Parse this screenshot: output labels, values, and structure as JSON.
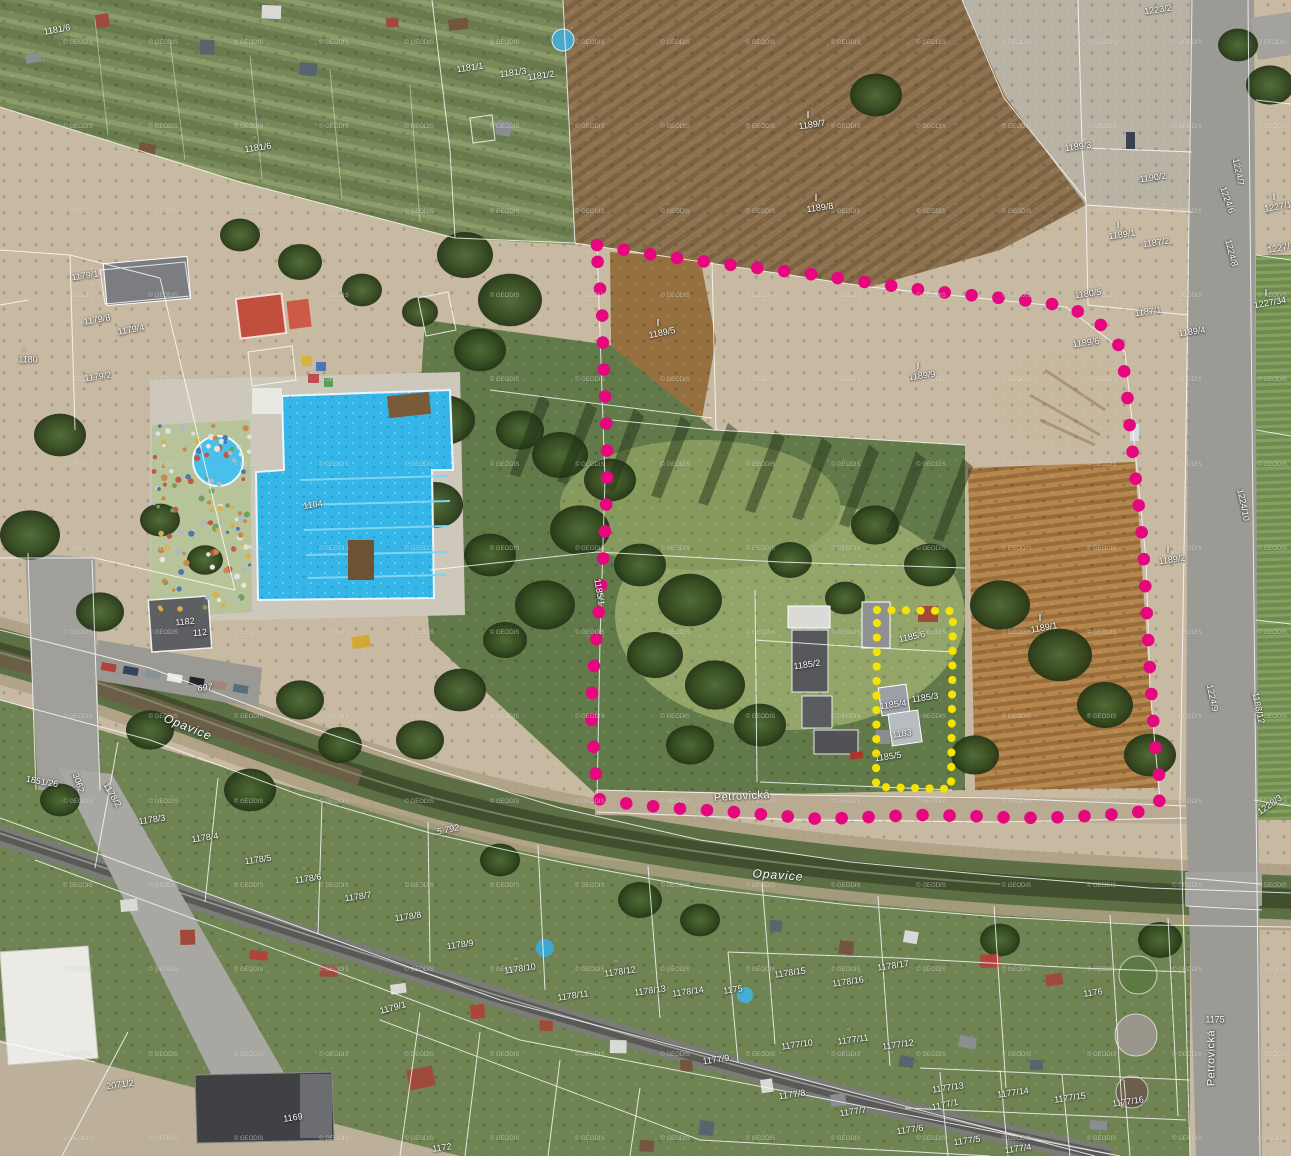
{
  "map": {
    "copyright": "© GEODIS",
    "watermark_grid": {
      "start_x": 78,
      "start_y": 43,
      "step_x": 85.3,
      "step_y": 84.3,
      "cols": 15,
      "rows": 14
    },
    "boundaries": {
      "selection_primary": {
        "name": "selection-boundary-magenta",
        "color": "#e6077e",
        "dot_radius": 6.3,
        "dot_spacing": 27,
        "vertices": [
          [
            597,
            245
          ],
          [
            660,
            256
          ],
          [
            740,
            266
          ],
          [
            810,
            274
          ],
          [
            872,
            283
          ],
          [
            930,
            291
          ],
          [
            980,
            296
          ],
          [
            1022,
            300
          ],
          [
            1066,
            306
          ],
          [
            1096,
            320
          ],
          [
            1118,
            343
          ],
          [
            1126,
            380
          ],
          [
            1130,
            430
          ],
          [
            1137,
            490
          ],
          [
            1143,
            545
          ],
          [
            1146,
            600
          ],
          [
            1149,
            655
          ],
          [
            1152,
            705
          ],
          [
            1156,
            755
          ],
          [
            1162,
            795
          ],
          [
            1155,
            810
          ],
          [
            1120,
            814
          ],
          [
            1070,
            817
          ],
          [
            1020,
            818
          ],
          [
            970,
            816
          ],
          [
            920,
            815
          ],
          [
            870,
            817
          ],
          [
            820,
            819
          ],
          [
            770,
            815
          ],
          [
            720,
            811
          ],
          [
            670,
            808
          ],
          [
            630,
            804
          ],
          [
            598,
            799
          ],
          [
            594,
            755
          ],
          [
            591,
            710
          ],
          [
            594,
            665
          ],
          [
            598,
            620
          ],
          [
            602,
            575
          ],
          [
            605,
            530
          ],
          [
            607,
            485
          ],
          [
            607,
            440
          ],
          [
            605,
            395
          ],
          [
            603,
            350
          ],
          [
            602,
            305
          ],
          [
            598,
            272
          ]
        ]
      },
      "selection_secondary": {
        "name": "selection-boundary-yellow",
        "color": "#f5e400",
        "dot_radius": 4.1,
        "dot_spacing": 14.5,
        "vertices": [
          [
            877,
            610
          ],
          [
            953,
            611
          ],
          [
            951,
            789
          ],
          [
            876,
            787
          ]
        ]
      }
    },
    "rivers": [
      {
        "name": "Opavice",
        "x": 188,
        "y": 727,
        "rot": 22
      },
      {
        "name": "Opavice",
        "x": 778,
        "y": 875,
        "rot": 4
      }
    ],
    "streets": [
      {
        "name": "Petrovická",
        "x": 742,
        "y": 797,
        "rot": -3
      },
      {
        "name": "Petrovická",
        "x": 1212,
        "y": 1058,
        "rot": -90
      }
    ],
    "parcel_labels": [
      {
        "t": "1181/6",
        "x": 57,
        "y": 30,
        "r": -10
      },
      {
        "t": "1181/1",
        "x": 470,
        "y": 68,
        "r": -8
      },
      {
        "t": "1181/3",
        "x": 513,
        "y": 73,
        "r": -8
      },
      {
        "t": "1181/2",
        "x": 541,
        "y": 76,
        "r": -8
      },
      {
        "t": "1223/2",
        "x": 1158,
        "y": 10,
        "r": -8
      },
      {
        "t": "1189/7",
        "x": 812,
        "y": 125,
        "r": -8,
        "sym": "slope"
      },
      {
        "t": "1181/6",
        "x": 258,
        "y": 148,
        "r": -8,
        "sym": "circle"
      },
      {
        "t": "1189/3",
        "x": 1078,
        "y": 147,
        "r": -8
      },
      {
        "t": "1190/2",
        "x": 1153,
        "y": 178,
        "r": -8
      },
      {
        "t": "1224/7",
        "x": 1238,
        "y": 172,
        "r": 78
      },
      {
        "t": "1224/6",
        "x": 1227,
        "y": 200,
        "r": 70
      },
      {
        "t": "1227/1",
        "x": 1278,
        "y": 207,
        "r": -10,
        "sym": "slope"
      },
      {
        "t": "1189/8",
        "x": 820,
        "y": 208,
        "r": -8,
        "sym": "slope"
      },
      {
        "t": "1189/1",
        "x": 1122,
        "y": 235,
        "r": -8,
        "sym": "slope"
      },
      {
        "t": "1187/2",
        "x": 1156,
        "y": 243,
        "r": -8
      },
      {
        "t": "1227/7",
        "x": 1281,
        "y": 248,
        "r": -10
      },
      {
        "t": "1224/8",
        "x": 1231,
        "y": 253,
        "r": 75
      },
      {
        "t": "1179/1",
        "x": 85,
        "y": 276,
        "r": -8
      },
      {
        "t": "1180/5",
        "x": 1088,
        "y": 294,
        "r": -8
      },
      {
        "t": "1227/34",
        "x": 1270,
        "y": 303,
        "r": -10,
        "sym": "slope"
      },
      {
        "t": "1187/1",
        "x": 1148,
        "y": 312,
        "r": -8
      },
      {
        "t": "1179/8",
        "x": 97,
        "y": 320,
        "r": -10
      },
      {
        "t": "1179/4",
        "x": 131,
        "y": 330,
        "r": -10
      },
      {
        "t": "1189/5",
        "x": 662,
        "y": 333,
        "r": -12,
        "sym": "slope"
      },
      {
        "t": "1189/6",
        "x": 1086,
        "y": 343,
        "r": -8
      },
      {
        "t": "1189/4",
        "x": 1192,
        "y": 332,
        "r": -8
      },
      {
        "t": "1180",
        "x": 28,
        "y": 360,
        "r": 0,
        "sym": "circle"
      },
      {
        "t": "1189/9",
        "x": 922,
        "y": 376,
        "r": -8,
        "sym": "slope"
      },
      {
        "t": "1179/2",
        "x": 98,
        "y": 377,
        "r": -8
      },
      {
        "t": "1184",
        "x": 313,
        "y": 505,
        "r": -8
      },
      {
        "t": "1224/10",
        "x": 1243,
        "y": 505,
        "r": 78
      },
      {
        "t": "1189/2",
        "x": 1172,
        "y": 560,
        "r": -8,
        "sym": "slope"
      },
      {
        "t": "1185/1",
        "x": 599,
        "y": 592,
        "r": 80
      },
      {
        "t": "1182",
        "x": 185,
        "y": 622,
        "r": -5
      },
      {
        "t": "112",
        "x": 200,
        "y": 633,
        "r": -5
      },
      {
        "t": "1185/6",
        "x": 912,
        "y": 637,
        "r": -12
      },
      {
        "t": "1189/1",
        "x": 1044,
        "y": 628,
        "r": -10,
        "sym": "slope"
      },
      {
        "t": "1185/2",
        "x": 807,
        "y": 665,
        "r": -8
      },
      {
        "t": "1224/9",
        "x": 1212,
        "y": 698,
        "r": 78
      },
      {
        "t": "1185/3",
        "x": 925,
        "y": 698,
        "r": -8
      },
      {
        "t": "1185/4",
        "x": 893,
        "y": 705,
        "r": -8
      },
      {
        "t": "1188/12",
        "x": 1258,
        "y": 708,
        "r": 78
      },
      {
        "t": "1183",
        "x": 902,
        "y": 734,
        "r": -8
      },
      {
        "t": "1185/5",
        "x": 888,
        "y": 757,
        "r": -8
      },
      {
        "t": "3062",
        "x": 78,
        "y": 783,
        "r": 72
      },
      {
        "t": "1851/26",
        "x": 42,
        "y": 782,
        "r": 10
      },
      {
        "t": "1178/2",
        "x": 112,
        "y": 795,
        "r": 60
      },
      {
        "t": "1228/3",
        "x": 1270,
        "y": 805,
        "r": -35
      },
      {
        "t": "1178/3",
        "x": 152,
        "y": 820,
        "r": -8
      },
      {
        "t": "1178/4",
        "x": 205,
        "y": 838,
        "r": -8
      },
      {
        "t": "1178/5",
        "x": 258,
        "y": 860,
        "r": -8
      },
      {
        "t": "1178/6",
        "x": 308,
        "y": 879,
        "r": -8,
        "sym": "circle"
      },
      {
        "t": "1178/7",
        "x": 358,
        "y": 897,
        "r": -8
      },
      {
        "t": "1178/8",
        "x": 408,
        "y": 917,
        "r": -8
      },
      {
        "t": "1178/9",
        "x": 460,
        "y": 945,
        "r": -8
      },
      {
        "t": "1178/10",
        "x": 520,
        "y": 969,
        "r": -8,
        "sym": "circle"
      },
      {
        "t": "1178/12",
        "x": 620,
        "y": 972,
        "r": -8,
        "sym": "circle"
      },
      {
        "t": "1178/17",
        "x": 893,
        "y": 966,
        "r": -8
      },
      {
        "t": "1178/15",
        "x": 790,
        "y": 973,
        "r": -8
      },
      {
        "t": "1178/16",
        "x": 848,
        "y": 982,
        "r": -8
      },
      {
        "t": "1175",
        "x": 733,
        "y": 990,
        "r": -8
      },
      {
        "t": "1176",
        "x": 1093,
        "y": 993,
        "r": -8
      },
      {
        "t": "1178/13",
        "x": 650,
        "y": 991,
        "r": -8
      },
      {
        "t": "1178/14",
        "x": 688,
        "y": 992,
        "r": -8
      },
      {
        "t": "1178/11",
        "x": 573,
        "y": 996,
        "r": -8
      },
      {
        "t": "1179/1",
        "x": 393,
        "y": 1008,
        "r": -15,
        "sym": "circle"
      },
      {
        "t": "1175",
        "x": 1215,
        "y": 1020,
        "r": 0
      },
      {
        "t": "1177/11",
        "x": 853,
        "y": 1040,
        "r": -8,
        "sym": "circle"
      },
      {
        "t": "1177/10",
        "x": 797,
        "y": 1045,
        "r": -8
      },
      {
        "t": "1177/12",
        "x": 898,
        "y": 1045,
        "r": -8
      },
      {
        "t": "1177/9",
        "x": 716,
        "y": 1060,
        "r": -8
      },
      {
        "t": "2071/2",
        "x": 120,
        "y": 1085,
        "r": -8
      },
      {
        "t": "1177/13",
        "x": 948,
        "y": 1088,
        "r": -8
      },
      {
        "t": "1177/14",
        "x": 1013,
        "y": 1093,
        "r": -8
      },
      {
        "t": "1177/8",
        "x": 792,
        "y": 1095,
        "r": -8
      },
      {
        "t": "1177/15",
        "x": 1070,
        "y": 1098,
        "r": -8
      },
      {
        "t": "1177/1",
        "x": 945,
        "y": 1105,
        "r": -12
      },
      {
        "t": "1177/16",
        "x": 1128,
        "y": 1102,
        "r": -8
      },
      {
        "t": "1177/7",
        "x": 853,
        "y": 1112,
        "r": -8
      },
      {
        "t": "1169",
        "x": 293,
        "y": 1118,
        "r": -8
      },
      {
        "t": "1177/6",
        "x": 910,
        "y": 1130,
        "r": -8
      },
      {
        "t": "1177/5",
        "x": 967,
        "y": 1141,
        "r": -8
      },
      {
        "t": "1172",
        "x": 442,
        "y": 1148,
        "r": -8
      },
      {
        "t": "1177/4",
        "x": 1018,
        "y": 1149,
        "r": -8
      }
    ],
    "annotations": [
      {
        "t": "697",
        "x": 205,
        "y": 688,
        "r": -8
      },
      {
        "t": "5.792",
        "x": 448,
        "y": 830,
        "r": -12
      }
    ]
  }
}
